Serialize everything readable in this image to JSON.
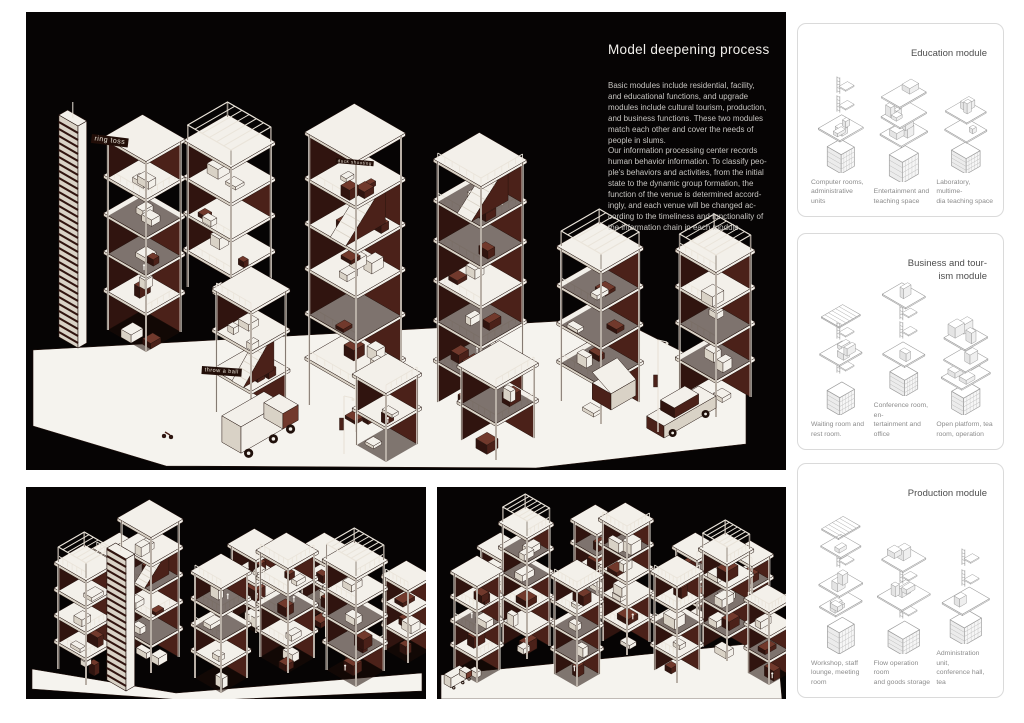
{
  "board": {
    "main": {
      "title": "Model deepening process",
      "body": "Basic modules include residential, facility,\nand educational functions, and upgrade\nmodules include cultural tourism, production,\nand business functions. These two modules\nmatch each other and cover the needs of\npeople in slums.\nOur information processing center records\nhuman behavior information. To classify peo-\nple's behaviors and activities, from the initial\nstate to the dynamic group formation, the\nfunction of the venue is determined accord-\ningly, and each venue will be changed ac-\ncording to the timeliness and functionality of\nthe information chain in each module.",
      "signs": {
        "sign1": "ring toss",
        "sign2": "duck shooting",
        "sign3": "throw a ball"
      }
    },
    "modules": [
      {
        "title": "Education module",
        "items": [
          {
            "caption": "Computer rooms,\nadministrative units"
          },
          {
            "caption": "Entertainment and\nteaching space"
          },
          {
            "caption": "Laboratory, multime-\ndia teaching space"
          }
        ]
      },
      {
        "title": "Business and tour-\nism module",
        "items": [
          {
            "caption": "Waiting room and\nrest room."
          },
          {
            "caption": "Conference room, en-\ntertainment and office"
          },
          {
            "caption": "Open platform, tea\nroom, operation"
          }
        ]
      },
      {
        "title": "Production module",
        "items": [
          {
            "caption": "Workshop, staff\nlounge, meeting room"
          },
          {
            "caption": "Flow operation room\nand goods storage"
          },
          {
            "caption": "Administration unit,\nconference hall, tea"
          }
        ]
      }
    ]
  },
  "colors": {
    "panel_bg": "#060404",
    "paper": "#f3f0ea",
    "paper_dim": "#d9d2c6",
    "line": "#20100b",
    "maroon_dark": "#30140f",
    "maroon_mid": "#4b2119",
    "maroon_light": "#71392c",
    "floor_dark": "#1d0c08",
    "col_light": "#eae4da",
    "ground": "#f5f3ee",
    "gray_stroke": "#9b9b9b",
    "card_border": "#dadada",
    "title_text": "#4d4d4d",
    "caption_text": "#8c8c8c",
    "body_text": "#c6c4c0",
    "sign_bg": "#220e08",
    "sign_text": "#ece6da"
  }
}
